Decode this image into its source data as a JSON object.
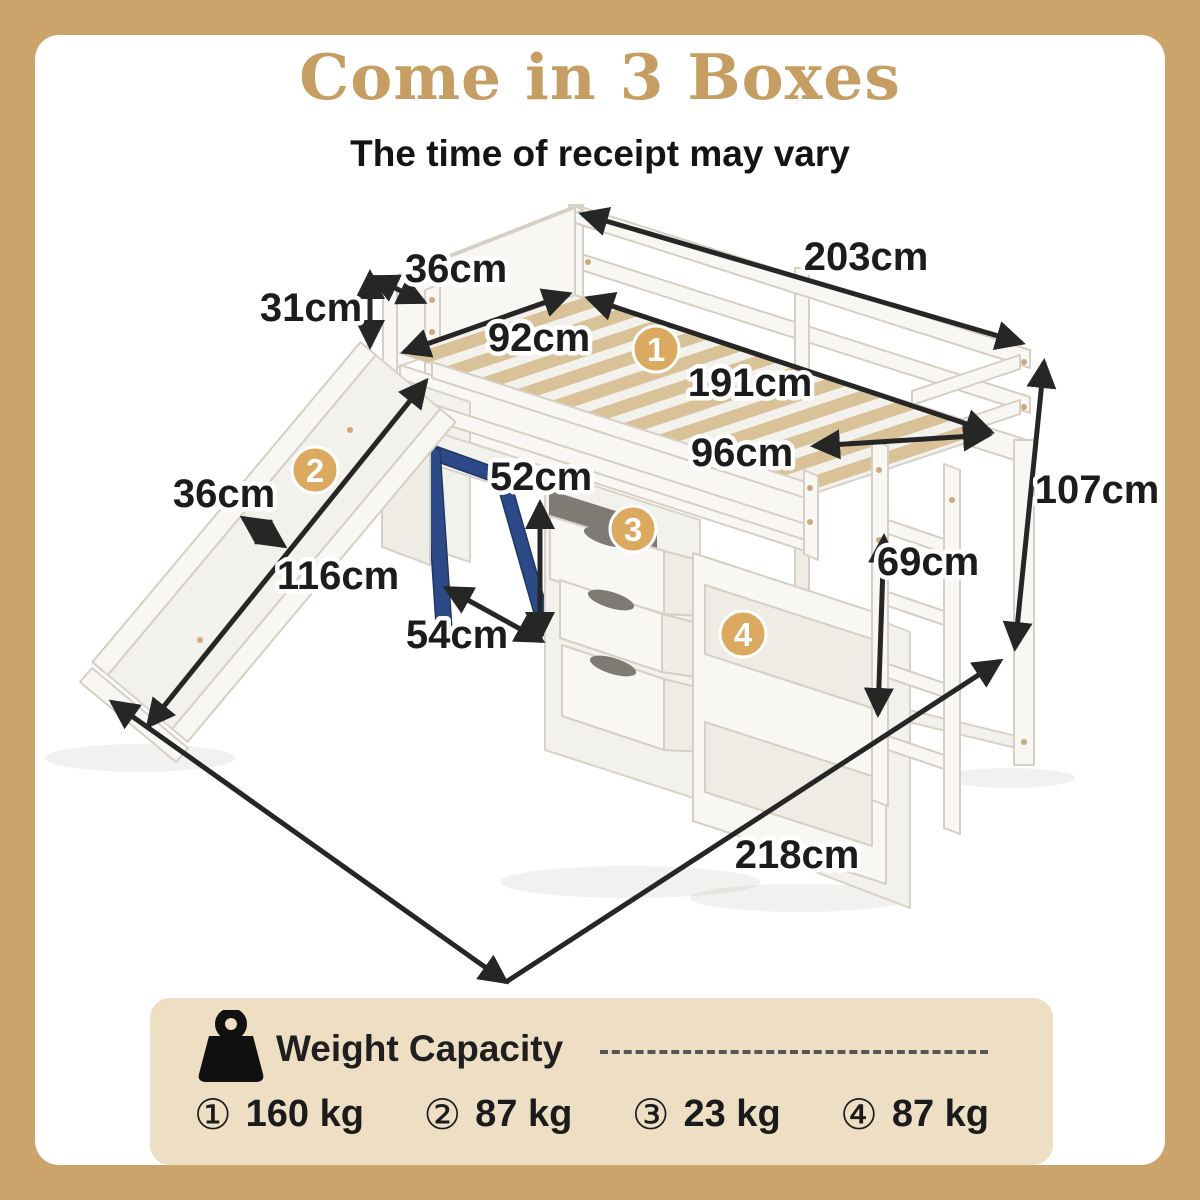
{
  "header": {
    "title": "Come in 3 Boxes",
    "subtitle": "The time of receipt may vary",
    "title_color": "#c69e63"
  },
  "diagram": {
    "badges": [
      {
        "n": "1",
        "part": "bed-frame"
      },
      {
        "n": "2",
        "part": "slide"
      },
      {
        "n": "3",
        "part": "drawers"
      },
      {
        "n": "4",
        "part": "shelves"
      }
    ],
    "dimensions": [
      {
        "id": "headboard-width",
        "label": "36cm"
      },
      {
        "id": "outer-length",
        "label": "203cm"
      },
      {
        "id": "headboard-height",
        "label": "31cm"
      },
      {
        "id": "inner-width",
        "label": "92cm"
      },
      {
        "id": "inner-length",
        "label": "191cm"
      },
      {
        "id": "foot-width",
        "label": "96cm"
      },
      {
        "id": "overall-height",
        "label": "107cm"
      },
      {
        "id": "slide-width",
        "label": "36cm"
      },
      {
        "id": "desk-height",
        "label": "52cm"
      },
      {
        "id": "clearance-height",
        "label": "69cm"
      },
      {
        "id": "slide-length",
        "label": "116cm"
      },
      {
        "id": "desk-depth",
        "label": "54cm"
      },
      {
        "id": "total-length",
        "label": "218cm"
      }
    ],
    "colors": {
      "accent_tan": "#dba95f",
      "frame_border": "#cba46c",
      "wood_slat": "#d9c198",
      "desk_blue": "#2c4a87"
    }
  },
  "weight_panel": {
    "icon": "kettlebell-weight-icon",
    "title": "Weight Capacity",
    "items": [
      {
        "marker": "①",
        "value": "160 kg"
      },
      {
        "marker": "②",
        "value": "87 kg"
      },
      {
        "marker": "③",
        "value": "23 kg"
      },
      {
        "marker": "④",
        "value": "87 kg"
      }
    ]
  }
}
